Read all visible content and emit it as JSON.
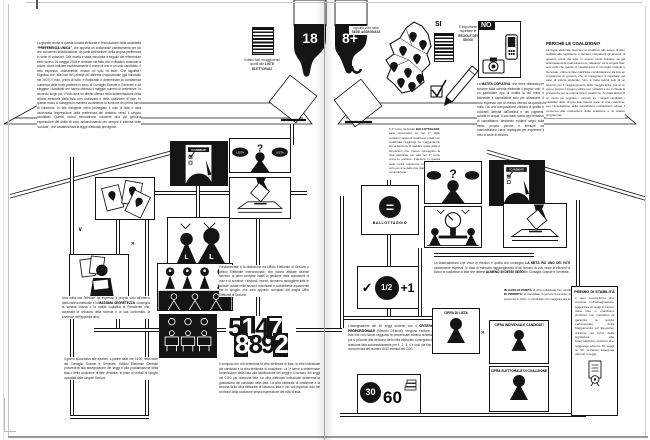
{
  "colors": {
    "ink": "#141414",
    "paper": "#ffffff"
  },
  "icons": {
    "question_mark": "?",
    "chevron_down": "∨",
    "chevron_right": "»",
    "check": "✓",
    "equals": "=",
    "list_letter": "L",
    "booth_ballot_header": "I CANDIDATI",
    "list_pill": "LISTA"
  },
  "left_page": {
    "age_label": "18",
    "intro_segments": [
      {
        "t": "La grande novità di questa tornata elettorale è l'introduzione della cosiddetta "
      },
      {
        "t": "“PREFERENZA UNICA”",
        "b": true
      },
      {
        "t": ", che apporta un sostanziale cambiamento per ciò che concerne l'individuazione, da parte dell'elettore, della propria preferenza in sede di votazioni. Tale novità è stata introdotta a seguito del referendum dello scorso 15 maggio 2016 e consiste nel fatto che il cittadino chiamato a votare dovrà indicare esclusivamente il nome di uno e un solo candidato. Il voto espresso, chiaramente, rimane un voto “di lista”. Che significa? Significa che, alla luce dei principi del sistema proporzionale (già introdotto nel 2007) il voto, prima di tutto, è finalizzato a determinare la consistenza numerica delle forze politiche in seno al Consiglio Grande e Generale e ad eleggere i candidati che hanno ottenuto il maggior numero di preferenze. In secondo luogo poi, il voto avrà un diretto riflesso nella determinazione della vittoria elettorale della lista non coalizzata o della coalizione di liste. In questo modo si ridisegna in maniera consistente la funzione del primo turno di votazione. In tale frangente verrà privilegiato il voto di lista e sarà valorizzata l'espressione della preferenza del cittadino verso il singolo candidato. Questo nuovo meccanismo consente una più genuina espressione del diritto di voto, abbandonando per sempre il sistema delle “cordate”, che caratterizzava la legge elettorale previgente."
      }
    ],
    "voters_caption_segments": [
      {
        "t": "Votano tutti i maggiorenni iscritti alle "
      },
      {
        "t": "LISTE ELETTORALI",
        "b": true
      }
    ],
    "massima_segments": [
      {
        "t": "Una volta che l'elettore ha espresso il proprio voto all'interno della cabina elettorale e in "
      },
      {
        "t": "MASSIMA SEGRETEZZA",
        "b": true
      },
      {
        "t": ", consegna la scheda chiusa e la matita copiativa al Presidente che, accertata la chiusura della scheda e la sua conformità, la inserisce nell'apposita urna."
      }
    ],
    "giorno_text": "Il giorno successivo alle elezioni, a partire dalle ore 14.00, nella sede del Consiglio Grande e Generale, l'Ufficio Elettorale Centrale provvederà alla assegnazione dei seggi e alla proclamazione della lista o della coalizione di liste vincitrice, in base ai verbali di spoglio compilati dalle singole Sezioni.",
    "fondamentale_text": "Fondamentale è la distinzione tra Ufficio Elettorale di Sezione e Ufficio Elettorale Intersezionale, che hanno affidate diverse funzioni: ai primi compete infatti la gestione delle operazioni di voto e di scrutinio; i secondi, invece, dovranno raccogliere tutte le schede votate nelle sezioni, mischiarle e suddividerle equamente per lo spoglio, che sarà appunto compiuto dai singoli Uffici Elettorali di Sezione.",
    "computo_text": "Il computo dei voti determina la cifra elettorale di lista, la cifra individuale dei candidati e la cifra elettorale di coalizione. La 1ª serve a determinare l'ammissione della lista alla distribuzione dei seggi e il numero dei seggi nel CGG per ciascuna lista. La cifra elettorale individuale determina la graduatoria dei candidati nella lista. La cifra elettorale di coalizione è la somma della cifra elettorale di ciascuna lista e dei voti espressi solo nei confronti della coalizione senza espressione del voto di lista.",
    "numbers": {
      "r1": [
        "5",
        "1",
        "4",
        "7"
      ],
      "r2": [
        "8",
        "8",
        "9",
        "2"
      ]
    }
  },
  "right_page": {
    "age_label": "8+",
    "map_caption_segments": [
      {
        "t": "ognuno vota nella "
      },
      {
        "t": "SEDE ASSEGNATA",
        "b": true
      }
    ],
    "si_label": "SI",
    "si_caption_segments": [
      {
        "t": "È importante rispettare le "
      },
      {
        "t": "REGOLE DEI SEGGI",
        "b": true
      }
    ],
    "no_label": "NO",
    "matita_segments": [
      {
        "t": "La "
      },
      {
        "t": "MATITA COPIATIVA",
        "b": true
      },
      {
        "t": ", che viene utilizzata per scrivere sulla scheda elettorale il proprio voto, è un particolare tipo di matita la cui mina è indelebile e cancellabile solo per abrasione. Il voto espresso con un mezzo diverso da questa è nullo. Ha una composizione chimica di grafite e coloranti derivati dall'anilina e dei pigmenti, solubili in acqua. Il suo tratto svela ogni tentativo di cancellatura, lasciando evidenti segni sulla carta: proprio perché è immune da manomissione viene impiegata per esprimere il voto in sede di elezioni."
      }
    ],
    "coalizioni_title": "PERCHÉ LE COALIZIONI?",
    "coalizioni_text": "La legge elettorale favorisce le coalizioni allo scopo di dare stabilità alla legislatura e rendere trasparenti gli accordi di governo prima del voto. In questo modo l'elettore sa già anticipatamente quali saranno le “alleanze” tra le singole liste: una volta che queste si insedieranno in Consiglio Grande e Generale, inoltre le liste coalizzate condivideranno tra loro un programma di governo che si impegnano a rispettare nel caso di vittoria elettorale. Non si tratta quindi solo di un accordo per il raggiungimento della maggioranza, ma di un vero e proprio impegno politico con i cittadini a cui si chiede la preferenza per la propria lista o coalizione. Si tratta altresì di un modo per regolare i rapporti tra i singoli candidati: i candidati delle singole liste facenti parte di una coalizione, con l'accettazione della candidatura manifestano altresì il consenso alla costituzione della coalizione e al relativo programma.",
    "ballottaggio_segments": [
      {
        "t": "Il 2° turno elettorale "
      },
      {
        "t": "BALLOTTAGGIO:",
        "b": true
      },
      {
        "t": " sarà necessario se nel 1° delle votazioni nessuna coalizione o lista non coalizzata raggiunge la maggioranza. Ha la funzione di stabilire quale delle 2 formazioni che hanno conseguito la cifra elettorale più alta nel 1° turno vinca le elezioni. L'elettore in questa sede potrà esprimere unicamente il voto per una delle due liste/coalizioni in competizione."
      }
    ],
    "ballottaggio_label": "BALLOTTAGGIO",
    "meta_segments": [
      {
        "t": "La lista/coalizione che vince le elezioni è quella che consegue "
      },
      {
        "t": "LA METÀ PIÙ UNO DEI VOTI",
        "b": true
      },
      {
        "t": " validamente espressi. In caso di mancato raggiungimento di tal numero di voti, vince le elezioni la lista o la coalizione di liste che ottiene "
      },
      {
        "t": "ALMENO 30 DEI 60 SEGGI",
        "b": true
      },
      {
        "t": " in Consiglio Grande e Generale."
      }
    ],
    "half": {
      "check": "✓",
      "fraction": "1/2",
      "plus": "+1"
    },
    "proporzionale_segments": [
      {
        "t": "L'assegnazione dei 60 seggi avviene con il "
      },
      {
        "t": "CRITERIO PROPORZIONALE",
        "b": true
      },
      {
        "t": " (Metodo D'Hondt): vengono escluse le liste che non hanno raggiunto la percentuale minima richiesta, poi si procede alla divisione della cifra elettorale conseguita da ciascuna lista successivamente per 1, 2, 3, 4 e così via fino a concorrenza del numero di 60 membri del CGG."
      }
    ],
    "seats": {
      "won": "30",
      "total": "60"
    },
    "parita_segments": [
      {
        "t": "IN CASO DI PARITÀ",
        "b": true
      },
      {
        "t": " di cifra individuale fra i candidati, si applicano i seguenti "
      },
      {
        "t": "CRITERI DI PRIORITÀ:",
        "b": true
      },
      {
        "t": " a) candidato di genere femminile; b) candidato con maggior anzianità di presenza in CGG; c) candidato con maggiore età anagrafica."
      }
    ],
    "cifra_lista_label": "CIFRA DI LISTA",
    "cifra_individuale_label": "CIFRA INDIVIDUALE CANDIDATI",
    "cifra_coalizione_label": "CIFRA ELETTORALE DI COALIZIONE",
    "premio_title": "PREMIO DI STABILITÀ",
    "premio_text": "è quel meccanismo che consiste nell'assegnazione aggiuntiva di seggi in favore della lista o coalizione vincitrice con l'obiettivo di garantire la tenuta parlamentare della Maggioranza ed Esecutivo durature nel corso della legislatura. Alla lista/coalizione vincitrice che raggiunge almeno 30 seggi su 60, verranno assegnati ulteriori 3 seggi."
  }
}
